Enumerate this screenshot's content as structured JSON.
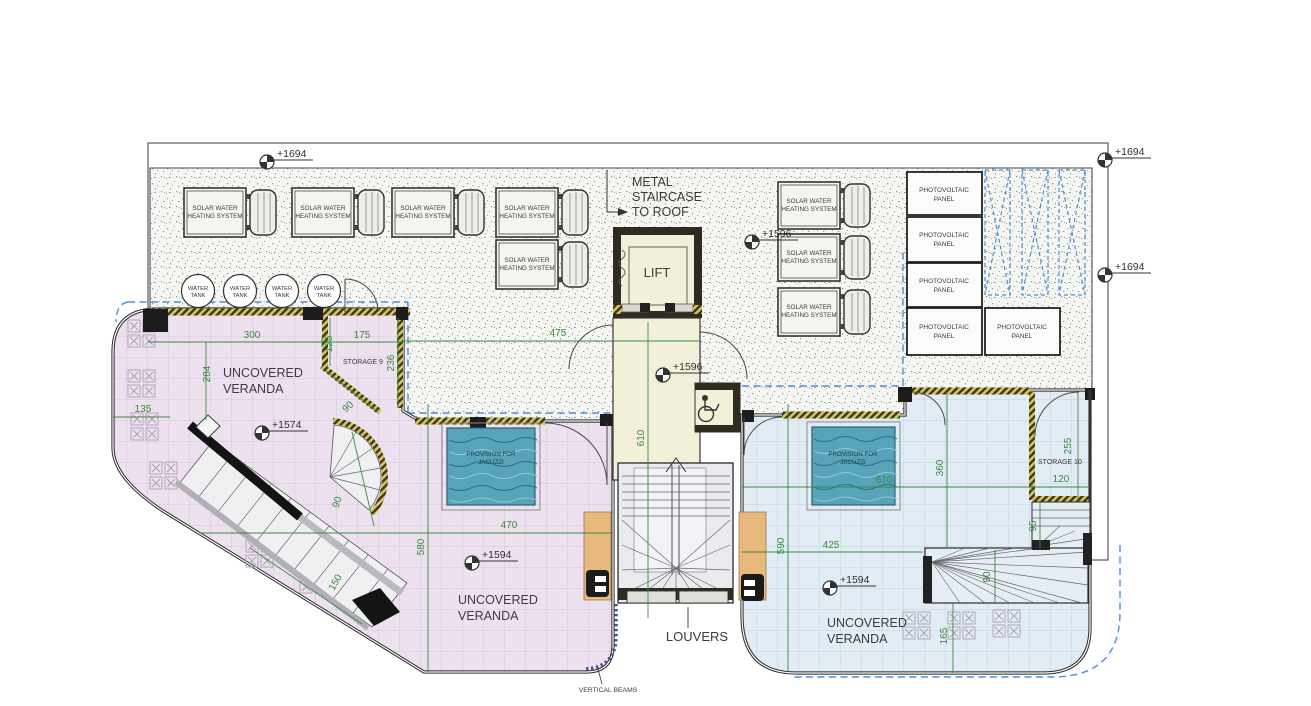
{
  "plan": {
    "labels": {
      "metal_staircase": [
        "METAL",
        "STAIRCASE",
        "TO ROOF"
      ],
      "lift": "LIFT",
      "louvers": "LOUVERS",
      "vertical_beams": "VERTICAL BEAMS",
      "uncovered": [
        "UNCOVERED",
        "VERANDA"
      ],
      "storage9": "STORAGE 9",
      "storage10": "STORAGE 10",
      "solar": [
        "SOLAR WATER",
        "HEATING SYSTEM"
      ],
      "water_tank": [
        "WATER",
        "TANK"
      ],
      "pv": [
        "PHOTOVOLTAIC",
        "PANEL"
      ],
      "jacuzzi": [
        "PROVISION FOR",
        "JACUZZI"
      ]
    },
    "levels": {
      "l1694": "+1694",
      "l1596": "+1596",
      "l1594": "+1594",
      "l1574": "+1574"
    },
    "dims": {
      "d300": "300",
      "d175": "175",
      "d125": "125",
      "d284": "284",
      "d135": "135",
      "d236": "236",
      "d475": "475",
      "d610": "610",
      "d580": "580",
      "d470": "470",
      "d590": "590",
      "d670": "670",
      "d360": "360",
      "d425": "425",
      "d255": "255",
      "d120": "120",
      "d95": "95",
      "d165": "165",
      "d150": "150",
      "d90": "90"
    },
    "colors": {
      "veranda_pink": "#ede1f0",
      "veranda_blue": "#e1ecf5",
      "jacuzzi_teal": "#57a3ba",
      "dimension_green": "#3a8a3e",
      "dashed_blue": "#4a90d9",
      "wall_dark": "#2f2b20",
      "column_orange": "#e7b97c"
    }
  }
}
